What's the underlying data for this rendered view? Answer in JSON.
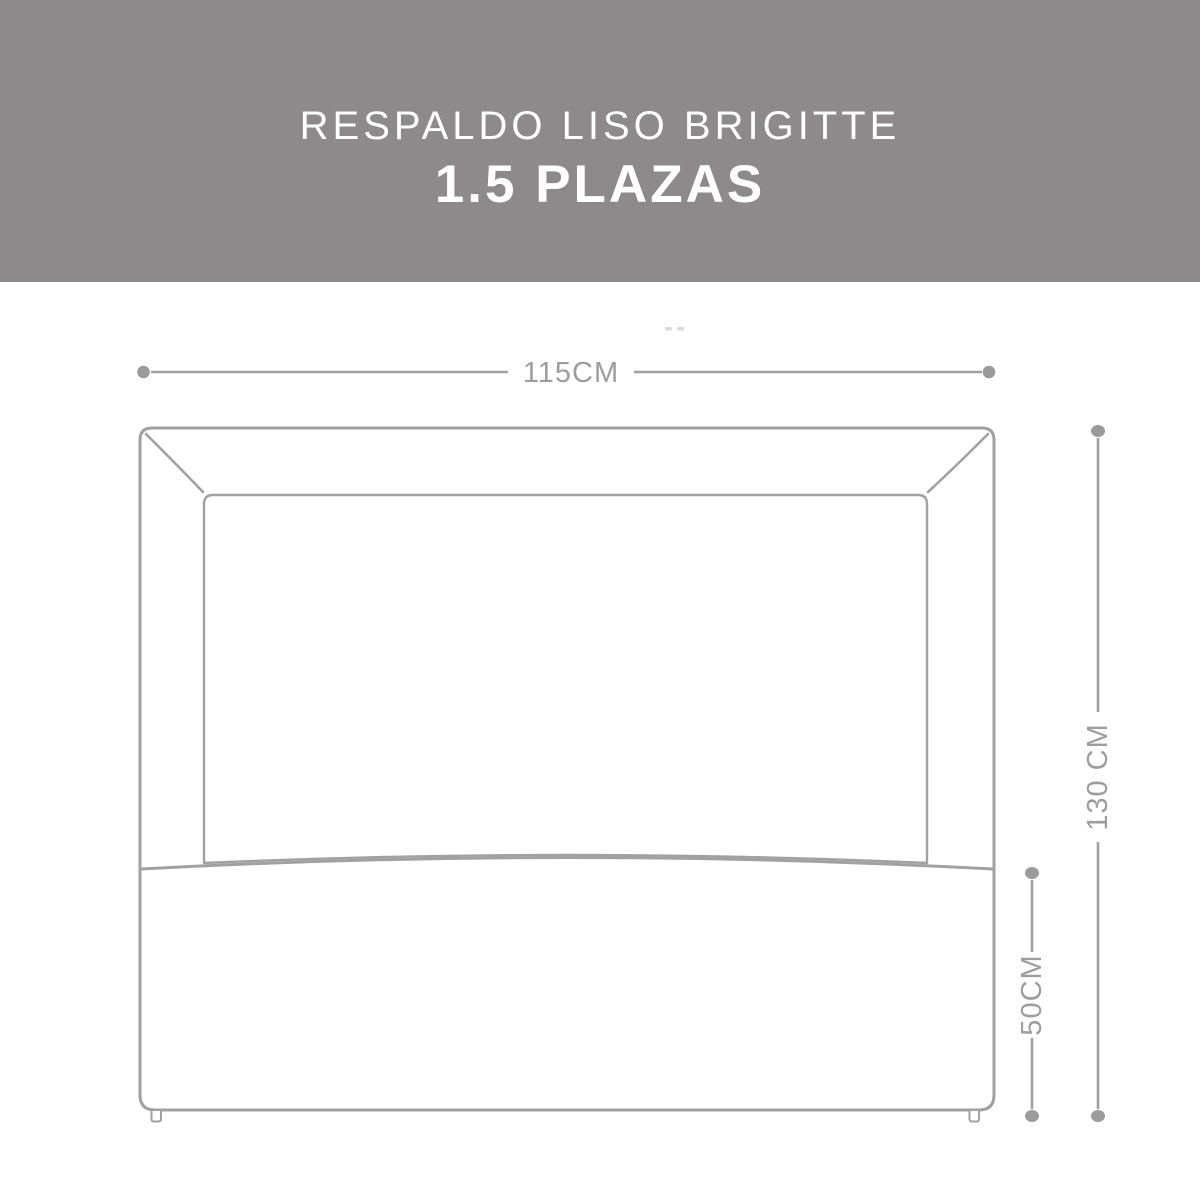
{
  "banner": {
    "line1": "RESPALDO LISO BRIGITTE",
    "line2": "1.5 PLAZAS",
    "bg_color": "#8e8a8b",
    "text_color": "#ffffff"
  },
  "dimensions": {
    "width_label": "115CM",
    "height_label": "130 CM",
    "lower_height_label": "50CM"
  },
  "diagram": {
    "subject": "headboard-front-outline-drawing",
    "line_color": "#a1a1a1",
    "marker_color": "#9b9b9b",
    "label_color": "#9d9d9d"
  }
}
